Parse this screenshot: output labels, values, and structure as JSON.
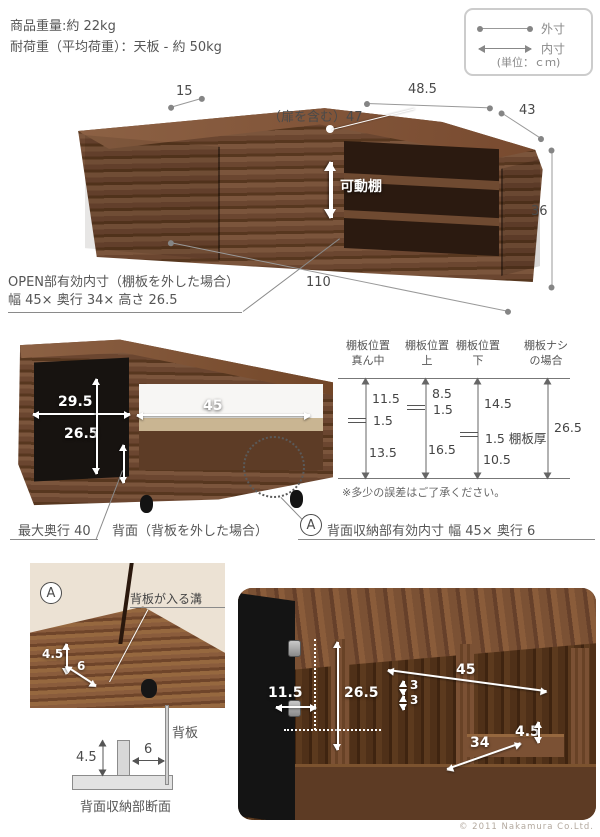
{
  "product_info": {
    "weight": "商品重量:約 22kg",
    "load": "耐荷重（平均荷重）：天板 - 約 50kg"
  },
  "legend": {
    "outer": "外寸",
    "inner": "内寸",
    "unit": "(単位：ｃｍ)"
  },
  "front_view": {
    "movable_shelf": "可動棚",
    "dims": {
      "left_depth": "15",
      "top_width": "48.5",
      "door_inclusive": "（扉を含む）47",
      "right_depth": "43",
      "height": "36",
      "total_width": "110"
    },
    "open_note_line1": "OPEN部有効内寸（棚板を外した場合）",
    "open_note_line2": "幅 45× 奥行 34× 高さ 26.5"
  },
  "rear_view": {
    "dims": {
      "corner_width": "29.5",
      "inner_height": "26.5",
      "open_width": "45"
    },
    "max_depth": "最大奥行 40",
    "caption": "背面（背板を外した場合）",
    "a_mark": "A",
    "a_note": "背面収納部有効内寸 幅 45× 奥行 6"
  },
  "shelf_chart": {
    "columns": [
      {
        "header_line1": "棚板位置",
        "header_line2": "真ん中",
        "top": "11.5",
        "middle": "1.5",
        "bottom": "13.5"
      },
      {
        "header_line1": "棚板位置",
        "header_line2": "上",
        "top": "8.5",
        "middle": "1.5",
        "bottom": "16.5"
      },
      {
        "header_line1": "棚板位置",
        "header_line2": "下",
        "top": "14.5",
        "middle": "1.5 棚板厚",
        "bottom": "10.5"
      },
      {
        "header_line1": "棚板ナシ",
        "header_line2": "の場合",
        "total": "26.5"
      }
    ],
    "note": "※多少の誤差はご了承ください。"
  },
  "detail_a": {
    "mark": "A",
    "groove_label": "背板が入る溝",
    "height": "4.5",
    "depth": "6"
  },
  "cross_section": {
    "back_panel": "背板",
    "height": "4.5",
    "gap": "6",
    "caption": "背面収納部断面"
  },
  "interior_view": {
    "dims": {
      "corner_depth": "11.5",
      "inner_height": "26.5",
      "open_width": "45",
      "pitch_upper": "3",
      "pitch_lower": "3",
      "open_depth": "34",
      "lip_height": "4.5"
    }
  },
  "copyright": "© 2011 Nakamura Co.Ltd."
}
